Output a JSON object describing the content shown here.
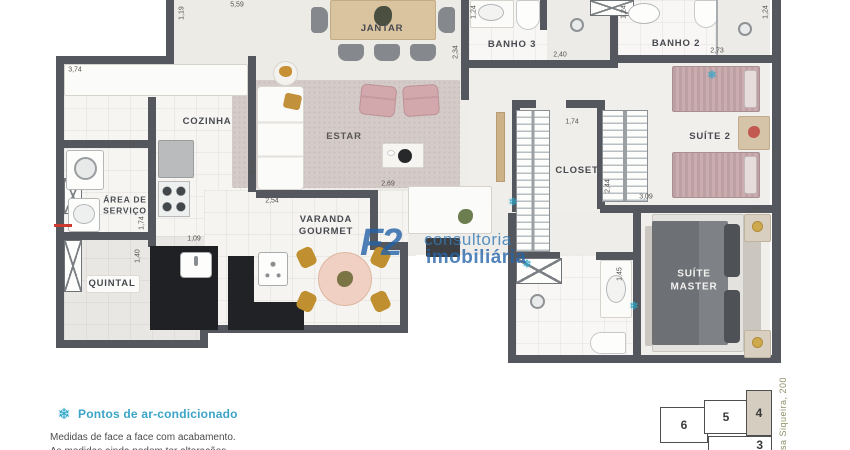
{
  "colors": {
    "wall": "#54575d",
    "accent_blue": "#2ba6c9",
    "watermark_blue": "#2a6fae",
    "keyplan_highlight": "#d5cdbf"
  },
  "rooms": [
    "JANTAR",
    "BANHO 3",
    "BANHO 2",
    "COZINHA",
    "ESTAR",
    "SUÍTE 2",
    "ÁREA DE\nSERVIÇO",
    "CLOSET",
    "VARANDA\nGOURMET",
    "QUINTAL",
    "SUÍTE\nMASTER"
  ],
  "dims": [
    "5,59",
    "1,19",
    "3,74",
    "1,62",
    "2,34",
    "1,24",
    "2,40",
    "1,24",
    "2,73",
    "1,24",
    "1,74",
    "2,44",
    "3,09",
    "4,18",
    "1,74",
    "1,40",
    "1,09",
    "2,54",
    "2,69",
    "1,45",
    "3,18"
  ],
  "icons": {
    "snowflake": "❄"
  },
  "watermark": {
    "logo": "F2",
    "line1": "consultoria",
    "line2": "imobiliária"
  },
  "legend": {
    "title": "Pontos de ar-condicionado",
    "note1": "Medidas de face a face com acabamento.",
    "note2": "As medidas ainda podem ter alterações."
  },
  "keyplan": {
    "units": [
      "6",
      "5",
      "4",
      "3"
    ],
    "highlighted_unit": "4",
    "street": "sa Siqueira, 200"
  }
}
